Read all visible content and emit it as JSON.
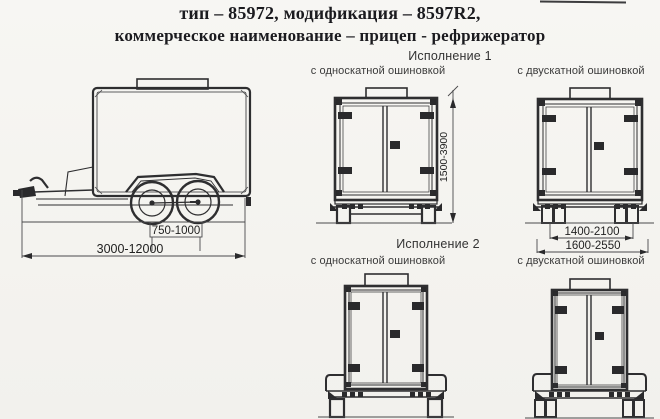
{
  "document": {
    "title_line1": "тип – 85972, модификация – 8597R2,",
    "title_line2": "коммерческое наименование – прицеп - рефрижератор"
  },
  "side_view": {
    "dim_axle_spacing": "750-1000",
    "dim_overall_length": "3000-12000"
  },
  "version_1": {
    "label": "Исполнение 1",
    "single_tire_label": "с односкатной ошиновкой",
    "dual_tire_label": "с двускатной ошиновкой",
    "dim_height": "1500-3900",
    "dim_track_width": "1400-2100",
    "dim_overall_width": "1600-2550"
  },
  "version_2": {
    "label": "Исполнение 2",
    "single_tire_label": "с односкатной ошиновкой",
    "dual_tire_label": "с двускатной ошиновкой"
  }
}
